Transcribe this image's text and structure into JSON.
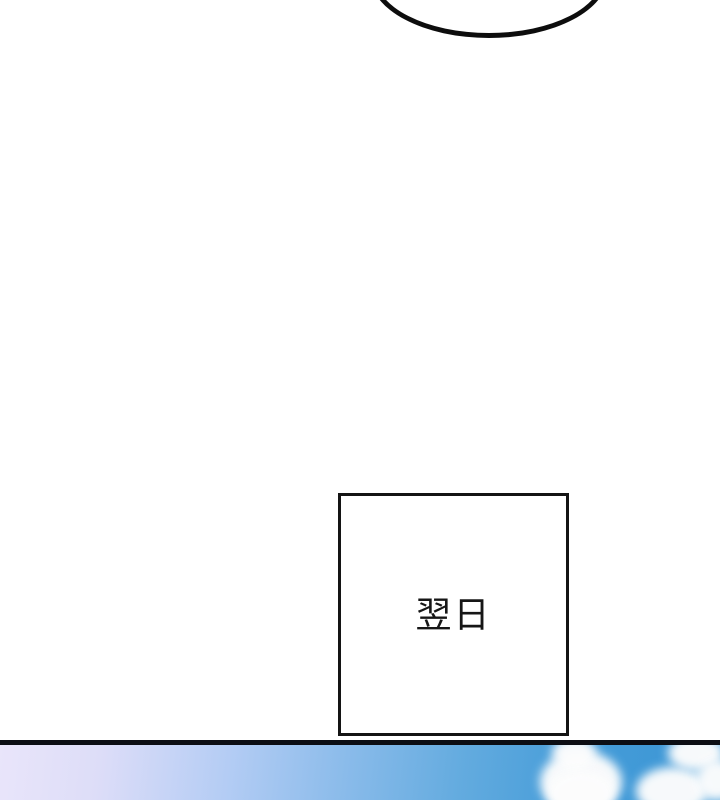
{
  "caption_panel": {
    "text": "翌日"
  },
  "colors": {
    "page_background": "#ffffff",
    "ink_outline": "#0d0d0d",
    "caption_border": "#141414",
    "panel_border": "#0c0e14",
    "sky_left_lavender": "#e9e5fa",
    "sky_mid_blue": "#8abbea",
    "sky_right_blue": "#3f98d6",
    "cloud_white": "#fdfdfd"
  }
}
